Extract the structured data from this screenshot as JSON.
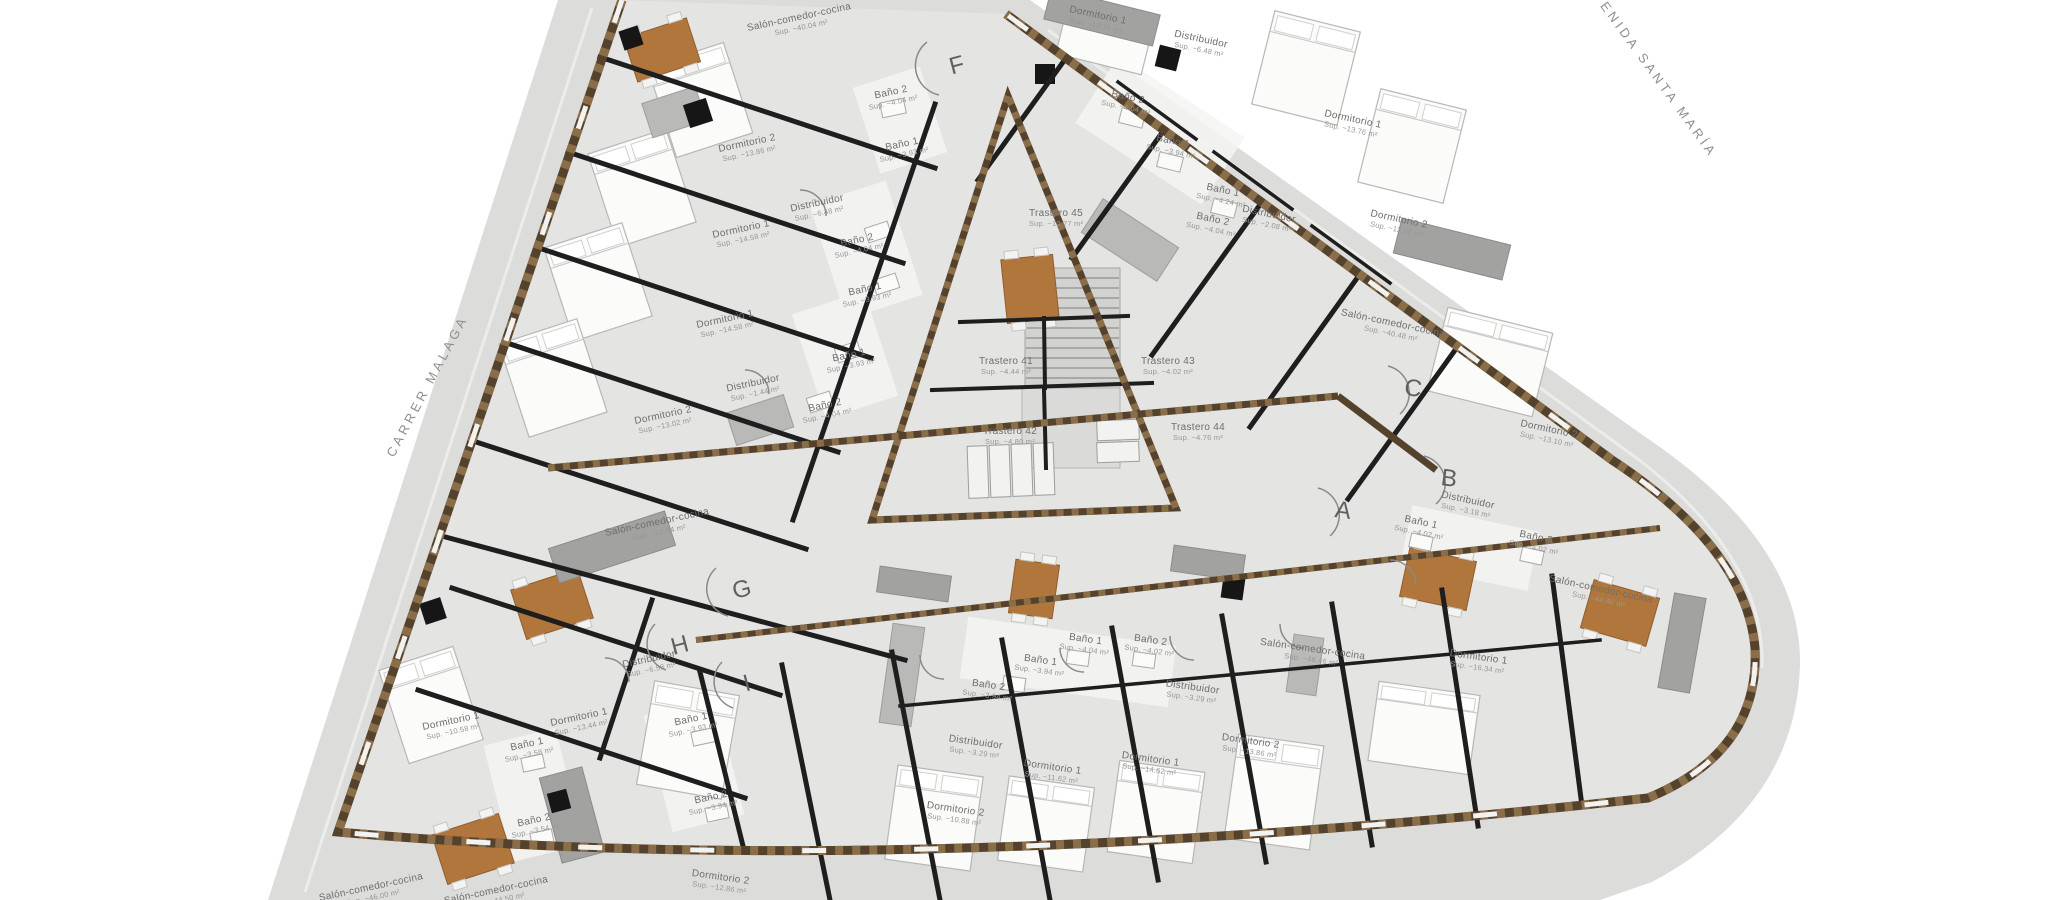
{
  "plan": {
    "kind": "residential-floor-plan",
    "streets": {
      "left": "CARRER MALAGA",
      "right": "AVENIDA SANTA MARÍA"
    },
    "unit_markers": [
      {
        "id": "f",
        "letter": "F"
      },
      {
        "id": "g",
        "letter": "G"
      },
      {
        "id": "h",
        "letter": "H"
      },
      {
        "id": "i",
        "letter": "I"
      },
      {
        "id": "a",
        "letter": "A"
      },
      {
        "id": "b",
        "letter": "B"
      },
      {
        "id": "c",
        "letter": "C"
      }
    ],
    "rooms": {
      "f_salon": {
        "label": "Salón-comedor-cocina",
        "area": "Sup. ~40.04 m²"
      },
      "f_dorm2": {
        "label": "Dormitorio 2",
        "area": "Sup. ~13.86 m²"
      },
      "f_distrib": {
        "label": "Distribuidor",
        "area": "Sup. ~6.48 m²"
      },
      "f_bano2a": {
        "label": "Baño 2",
        "area": "Sup. ~4.04 m²"
      },
      "f_bano1a": {
        "label": "Baño 1",
        "area": "Sup. ~3.93 m²"
      },
      "f_dorm1": {
        "label": "Dormitorio 1",
        "area": "Sup. ~14.58 m²"
      },
      "f_bano2b": {
        "label": "Baño 2",
        "area": "Sup. ~4.04 m²"
      },
      "f_bano1b": {
        "label": "Baño 1",
        "area": "Sup. ~3.93 m²"
      },
      "g_dorm1": {
        "label": "Dormitorio 1",
        "area": "Sup. ~14.58 m²"
      },
      "g_bano1": {
        "label": "Baño 1",
        "area": "Sup. ~3.93 m²"
      },
      "g_distrib": {
        "label": "Distribuidor",
        "area": "Sup. ~1.44 m²"
      },
      "g_bano2": {
        "label": "Baño 2",
        "area": "Sup. ~4.04 m²"
      },
      "g_dorm2": {
        "label": "Dormitorio 2",
        "area": "Sup. ~13.02 m²"
      },
      "g_salon": {
        "label": "Salón-comedor-cocina",
        "area": "Sup. ~52.54 m²"
      },
      "e_dorm1": {
        "label": "Dormitorio 1",
        "area": "Sup. ~13.76 m²"
      },
      "e_distrib": {
        "label": "Distribuidor",
        "area": "Sup. ~6.48 m²"
      },
      "e_bano2": {
        "label": "Baño 2",
        "area": "Sup. ~4.04 m²"
      },
      "e_bano1": {
        "label": "Baño 1",
        "area": "Sup. ~3.94 m²"
      },
      "d_dorm1": {
        "label": "Dormitorio 1",
        "area": "Sup. ~13.76 m²"
      },
      "d_bano1": {
        "label": "Baño 1",
        "area": "Sup. ~4.24 m²"
      },
      "d_bano2": {
        "label": "Baño 2",
        "area": "Sup. ~4.04 m²"
      },
      "d_distrib": {
        "label": "Distribuidor",
        "area": "Sup. ~2.08 m²"
      },
      "d_dorm2": {
        "label": "Dormitorio 2",
        "area": "Sup. ~13.08 m²"
      },
      "c_salon": {
        "label": "Salón-comedor-cocina",
        "area": "Sup. ~40.48 m²"
      },
      "c_dorm2": {
        "label": "Dormitorio 2",
        "area": "Sup. ~13.10 m²"
      },
      "b_distrib": {
        "label": "Distribuidor",
        "area": "Sup. ~3.18 m²"
      },
      "b_bano1": {
        "label": "Baño 1",
        "area": "Sup. ~4.02 m²"
      },
      "b_bano2": {
        "label": "Baño 2",
        "area": "Sup. ~4.02 m²"
      },
      "b_salon": {
        "label": "Salón-comedor-cocina",
        "area": "Sup. ~44.46 m²"
      },
      "a_salon": {
        "label": "Salón-comedor-cocina",
        "area": "Sup. ~48.46 m²"
      },
      "a_dorm1": {
        "label": "Dormitorio 1",
        "area": "Sup. ~16.34 m²"
      },
      "a_dorm2": {
        "label": "Dormitorio 2",
        "area": "Sup. ~13.86 m²"
      },
      "s1_bano1": {
        "label": "Baño 1",
        "area": "Sup. ~4.04 m²"
      },
      "s1_bano2": {
        "label": "Baño 2",
        "area": "Sup. ~4.02 m²"
      },
      "s1_distrib": {
        "label": "Distribuidor",
        "area": "Sup. ~3.29 m²"
      },
      "s1_dorm1": {
        "label": "Dormitorio 1",
        "area": "Sup. ~14.62 m²"
      },
      "s2_bano1": {
        "label": "Baño 1",
        "area": "Sup. ~3.94 m²"
      },
      "s2_bano2": {
        "label": "Baño 2",
        "area": "Sup. ~3.94 m²"
      },
      "s2_distrib": {
        "label": "Distribuidor",
        "area": "Sup. ~3.29 m²"
      },
      "s2_dorm1": {
        "label": "Dormitorio 1",
        "area": "Sup. ~11.62 m²"
      },
      "s2_dorm2": {
        "label": "Dormitorio 2",
        "area": "Sup. ~10.88 m²"
      },
      "s3_dorm2": {
        "label": "Dormitorio 2",
        "area": "Sup. ~12.86 m²"
      },
      "h_distrib": {
        "label": "Distribuidor",
        "area": "Sup. ~6.58 m²"
      },
      "h_dorm1": {
        "label": "Dormitorio 1",
        "area": "Sup. ~13.44 m²"
      },
      "h_bano1": {
        "label": "Baño 1",
        "area": "Sup. ~3.93 m²"
      },
      "h_bano2": {
        "label": "Baño 2",
        "area": "Sup. ~3.94 m²"
      },
      "h_salon": {
        "label": "Salón-comedor-cocina",
        "area": "Sup. ~44.50 m²"
      },
      "i_dorm1": {
        "label": "Dormitorio 1",
        "area": "Sup. ~10.58 m²"
      },
      "i_bano1": {
        "label": "Baño 1",
        "area": "Sup. ~3.58 m²"
      },
      "i_bano2": {
        "label": "Baño 2",
        "area": "Sup. ~3.54 m²"
      },
      "i_salon": {
        "label": "Salón-comedor-cocina",
        "area": "Sup. ~46.00 m²"
      },
      "t45": {
        "label": "Trastero 45",
        "area": "Sup. ~10.77 m²"
      },
      "t41": {
        "label": "Trastero 41",
        "area": "Sup. ~4.44 m²"
      },
      "t43": {
        "label": "Trastero 43",
        "area": "Sup. ~4.02 m²"
      },
      "t42": {
        "label": "Trastero 42",
        "area": "Sup. ~4.80 m²"
      },
      "t44": {
        "label": "Trastero 44",
        "area": "Sup. ~4.76 m²"
      }
    },
    "colors": {
      "pavement": "#dcdcdb",
      "floor": "#e4e4e3",
      "wall_exterior": "#54422c",
      "wall_hatch": "#86laterbrown",
      "wall_interior": "#1e1e1e",
      "table_wood": "#b0763c",
      "counter_gray": "#a2a2a1",
      "stairs_gray": "#d2d2d1",
      "label_text": "#6e6e6e"
    }
  }
}
